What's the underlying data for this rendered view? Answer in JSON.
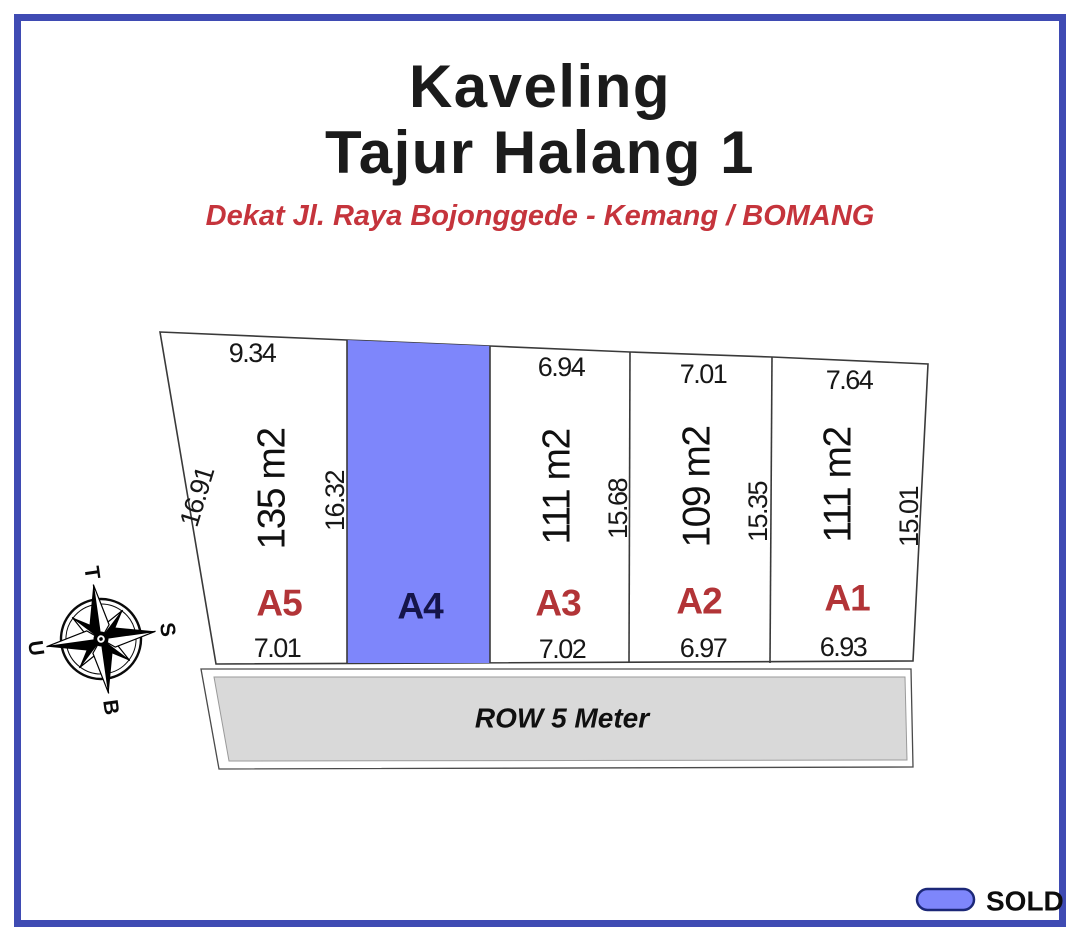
{
  "title": {
    "line1": "Kaveling",
    "line2": "Tajur Halang 1"
  },
  "subtitle": "Dekat Jl. Raya Bojonggede - Kemang / BOMANG",
  "compass": {
    "top": "T",
    "right": "S",
    "bottom": "B",
    "left": "U"
  },
  "plots": [
    {
      "id": "A1",
      "area": "111 m2",
      "top_width": "7.64",
      "bottom_width": "6.93",
      "side": "15.01",
      "status": "available"
    },
    {
      "id": "A2",
      "area": "109 m2",
      "top_width": "7.01",
      "bottom_width": "6.97",
      "side": "15.35",
      "status": "available"
    },
    {
      "id": "A3",
      "area": "111 m2",
      "top_width": "6.94",
      "bottom_width": "7.02",
      "side": "15.68",
      "status": "available"
    },
    {
      "id": "A4",
      "status": "sold"
    },
    {
      "id": "A5",
      "area": "135 m2",
      "top_width": "9.34",
      "bottom_width": "7.01",
      "side_left": "16.91",
      "side_right": "16.32",
      "status": "available"
    }
  ],
  "road": {
    "label": "ROW 5 Meter"
  },
  "legend": {
    "sold_label": "SOLD"
  },
  "colors": {
    "sold_fill": "#7E86FB",
    "frame_blue": "#3F4BB3",
    "road_gray": "#D9D9D9",
    "subtitle_red": "#C5343C",
    "plot_label_red": "#B23437",
    "sold_label_dark": "#15154A",
    "compass_north_red": "#B23437"
  }
}
